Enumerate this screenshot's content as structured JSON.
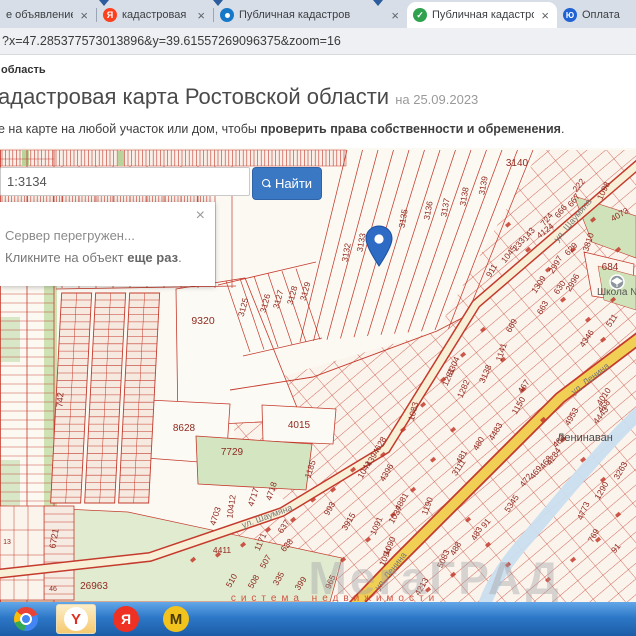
{
  "browser": {
    "tabs": [
      {
        "title": "е объявление —",
        "icon": "none",
        "active": false,
        "close": "×"
      },
      {
        "title": "кадастровая карта рос",
        "icon": "yandex",
        "active": false,
        "close": "×"
      },
      {
        "title": "Публичная кадастров",
        "icon": "pkk",
        "active": false,
        "close": "×"
      },
      {
        "title": "Публичная кадастров",
        "icon": "check",
        "active": true,
        "close": "×"
      },
      {
        "title": "Оплата",
        "icon": "yoo",
        "active": false,
        "close": ""
      }
    ],
    "url": "?x=47.285377573013896&y=39.61557269096375&zoom=16"
  },
  "page": {
    "breadcrumb": "область",
    "title": "адастровая карта Ростовской области",
    "title_date": "на 25.09.2023",
    "subtitle_prefix": "е на карте на любой участок или дом, чтобы ",
    "subtitle_bold": "проверить права собственности и обременения",
    "subtitle_suffix": "."
  },
  "search": {
    "value": "1:3134",
    "button_label": "Найти"
  },
  "popup": {
    "close": "×",
    "line1": "Сервер перегружен...",
    "line2_prefix": "Кликните на объект ",
    "line2_bold": "еще раз",
    "line2_suffix": "."
  },
  "map": {
    "place_label": "Ленинаван",
    "school_label": "Школа №",
    "watermark_big": "МегаГРАД",
    "watermark_small": "система недвижимости",
    "streets": [
      [
        "ул. Шаумяна",
        575,
        222,
        -50
      ],
      [
        "ул. Шаумяна",
        268,
        519,
        -20
      ],
      [
        "ул. Ленина",
        592,
        381,
        -38
      ],
      [
        "ул. Ленина",
        393,
        573,
        -52
      ]
    ],
    "parcels": [
      [
        "3140",
        517,
        166,
        0,
        10
      ],
      [
        "3139",
        486,
        186,
        -80
      ],
      [
        "3138",
        467,
        197,
        -80
      ],
      [
        "3137",
        448,
        208,
        -80
      ],
      [
        "3136",
        431,
        211,
        -80
      ],
      [
        "3135",
        406,
        219,
        -80
      ],
      [
        "3133",
        364,
        243,
        -80
      ],
      [
        "3132",
        349,
        253,
        -80
      ],
      [
        "3125",
        246,
        308,
        -75
      ],
      [
        "3126",
        268,
        304,
        -75
      ],
      [
        "3127",
        281,
        300,
        -75
      ],
      [
        "3128",
        295,
        296,
        -75
      ],
      [
        "3129",
        308,
        292,
        -75
      ],
      [
        "9320",
        203,
        324,
        0,
        10.5
      ],
      [
        "222",
        581,
        187,
        -52
      ],
      [
        "1098",
        606,
        192,
        -64
      ],
      [
        "667",
        576,
        202,
        -52
      ],
      [
        "666",
        563,
        213,
        -52
      ],
      [
        "724",
        549,
        221,
        -52
      ],
      [
        "4124",
        547,
        233,
        -38
      ],
      [
        "4073",
        621,
        217,
        -30
      ],
      [
        "143",
        531,
        236,
        -52
      ],
      [
        "233",
        521,
        246,
        -52
      ],
      [
        "1045",
        511,
        256,
        -52
      ],
      [
        "911",
        494,
        272,
        -60
      ],
      [
        "629",
        573,
        251,
        -46
      ],
      [
        "3810",
        591,
        243,
        -72
      ],
      [
        "2997",
        558,
        266,
        -60
      ],
      [
        "2996",
        575,
        284,
        -60
      ],
      [
        "630",
        562,
        289,
        -56
      ],
      [
        "1309",
        541,
        286,
        -56
      ],
      [
        "663",
        545,
        309,
        -60
      ],
      [
        "684",
        610,
        270,
        0,
        10
      ],
      [
        "669",
        514,
        327,
        -60
      ],
      [
        "1141",
        504,
        353,
        -72
      ],
      [
        "511",
        614,
        322,
        -56
      ],
      [
        "4346",
        589,
        340,
        -56
      ],
      [
        "3304",
        456,
        367,
        -66
      ],
      [
        "1281",
        451,
        378,
        -66
      ],
      [
        "1282",
        466,
        390,
        -66
      ],
      [
        "3138",
        488,
        375,
        -66
      ],
      [
        "467",
        526,
        388,
        -56
      ],
      [
        "1150",
        521,
        407,
        -60
      ],
      [
        "1083",
        416,
        412,
        -76
      ],
      [
        "4483",
        498,
        433,
        -60
      ],
      [
        "480",
        481,
        445,
        -60
      ],
      [
        "628",
        383,
        445,
        -60
      ],
      [
        "481",
        464,
        458,
        -60
      ],
      [
        "3111",
        461,
        469,
        -56
      ],
      [
        "4394",
        375,
        459,
        -60
      ],
      [
        "1041",
        367,
        471,
        -60
      ],
      [
        "4396",
        389,
        474,
        -60
      ],
      [
        "993",
        332,
        510,
        -60
      ],
      [
        "3915",
        351,
        523,
        -60
      ],
      [
        "1190",
        430,
        507,
        -70
      ],
      [
        "4881",
        404,
        503,
        -60
      ],
      [
        "1037",
        398,
        516,
        -60
      ],
      [
        "1091",
        379,
        527,
        -66
      ],
      [
        "1090",
        392,
        547,
        -66
      ],
      [
        "1094",
        388,
        558,
        -66
      ],
      [
        "5345",
        514,
        505,
        -56
      ],
      [
        "91",
        488,
        525,
        -50
      ],
      [
        "483",
        479,
        535,
        -60
      ],
      [
        "488",
        458,
        550,
        -60
      ],
      [
        "5083",
        446,
        560,
        -66
      ],
      [
        "4213",
        424,
        588,
        -60
      ],
      [
        "965",
        333,
        583,
        -66
      ],
      [
        "464",
        561,
        443,
        -46
      ],
      [
        "4284",
        556,
        458,
        -56
      ],
      [
        "468",
        548,
        464,
        -52
      ],
      [
        "469",
        538,
        474,
        -52
      ],
      [
        "472",
        528,
        482,
        -52
      ],
      [
        "4010",
        606,
        398,
        -56
      ],
      [
        "458",
        606,
        408,
        -50
      ],
      [
        "4443",
        603,
        417,
        -52
      ],
      [
        "4953",
        574,
        418,
        -60
      ],
      [
        "3263",
        623,
        472,
        -60
      ],
      [
        "1290",
        604,
        492,
        -60
      ],
      [
        "4773",
        586,
        512,
        -66
      ],
      [
        "769",
        596,
        537,
        -60
      ],
      [
        "91",
        618,
        550,
        -50
      ],
      [
        "4718",
        274,
        492,
        -72
      ],
      [
        "4717",
        256,
        498,
        -72
      ],
      [
        "10412",
        234,
        507,
        -82
      ],
      [
        "4703",
        218,
        517,
        -72
      ],
      [
        "637",
        286,
        528,
        -56
      ],
      [
        "638",
        289,
        547,
        -50
      ],
      [
        "1171",
        263,
        543,
        -66
      ],
      [
        "4411",
        222,
        553,
        0
      ],
      [
        "507",
        268,
        563,
        -60
      ],
      [
        "508",
        256,
        583,
        -60
      ],
      [
        "510",
        234,
        582,
        -60
      ],
      [
        "335",
        281,
        580,
        -60
      ],
      [
        "399",
        303,
        585,
        -56
      ],
      [
        "1185",
        313,
        470,
        -72
      ],
      [
        "8628",
        184,
        431,
        0,
        10
      ],
      [
        "4015",
        299,
        428,
        0,
        10
      ],
      [
        "7729",
        232,
        455,
        0,
        10
      ],
      [
        "26963",
        94,
        589,
        0,
        10
      ],
      [
        "6721",
        57,
        539,
        -80,
        9
      ],
      [
        "742",
        63,
        400,
        -86,
        9
      ],
      [
        "13",
        7,
        544,
        0,
        7
      ],
      [
        "46",
        53,
        591,
        0,
        7
      ]
    ]
  },
  "colors": {
    "accent_blue": "#3b78c4",
    "parcel_line": "#c43a2c",
    "parcel_label": "#8f2a20",
    "street_label": "#777777",
    "place_label": "#4a4a4a",
    "road_yellow": "#f1cf55",
    "road_pale": "#f8f0d6",
    "river_blue": "#cadeef",
    "green": "#d4e5c2",
    "pin_blue": "#2e6bc4"
  },
  "taskbar": {
    "icons": [
      "chrome",
      "yandex-browser",
      "yandex-search",
      "megagrad"
    ],
    "yandex_browser_letter": "Y",
    "yandex_search_letter": "Я",
    "megagrad_letter": "М"
  }
}
